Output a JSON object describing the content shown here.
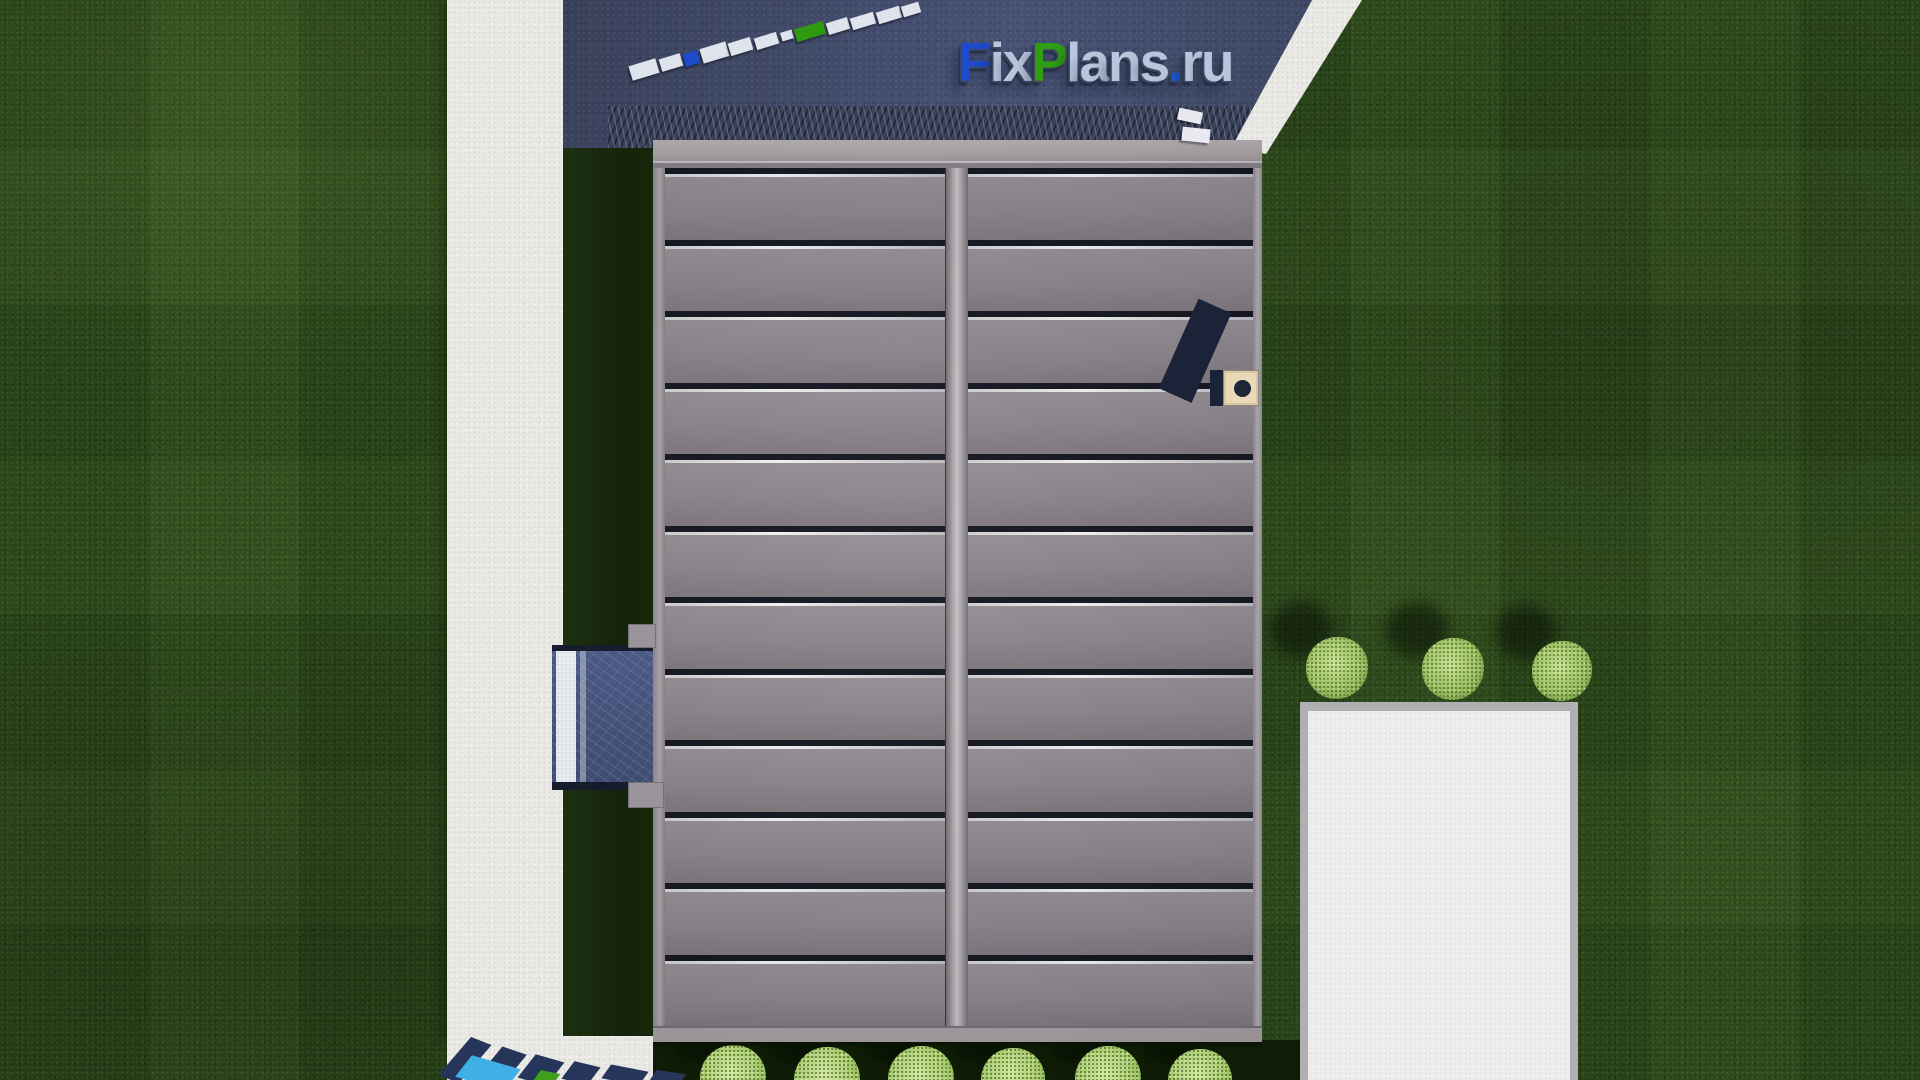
{
  "site": {
    "watermark_text": "FixPlans.ru"
  },
  "logo": {
    "letters": [
      {
        "ch": "F",
        "color": "#1d4bc9"
      },
      {
        "ch": "i",
        "color": "#b9c5dc"
      },
      {
        "ch": "x",
        "color": "#b9c5dc"
      },
      {
        "ch": "P",
        "color": "#2f9e12"
      },
      {
        "ch": "l",
        "color": "#b9c5dc"
      },
      {
        "ch": "a",
        "color": "#b9c5dc"
      },
      {
        "ch": "n",
        "color": "#b9c5dc"
      },
      {
        "ch": "s",
        "color": "#b9c5dc"
      },
      {
        "ch": ".",
        "color": "#1d5ad9"
      },
      {
        "ch": "r",
        "color": "#b9c5dc"
      },
      {
        "ch": "u",
        "color": "#b9c5dc"
      }
    ]
  },
  "colors": {
    "grass": "#2b471b",
    "grass_shadow": "#142309",
    "footpath": "#e9e8e5",
    "driveway": "#3f4860",
    "roof_panel": "#8a838a",
    "roof_seam_dark": "#10131d",
    "roof_seam_light": "#f4f4f6",
    "ridge": "#c6c1c5",
    "chimney_body": "#ead9b6",
    "chimney_flue": "#1e2636",
    "porch": "#46547a",
    "patio": "#ededef",
    "tree": "#97be5d",
    "logo_blue": "#1d4bc9",
    "logo_green": "#2f9e12",
    "logo_silver": "#b9c5dc"
  },
  "roof": {
    "panels_per_slope": 12,
    "slopes": 2
  },
  "ground_watermark": {
    "pieces": [
      {
        "x": 630,
        "y": 62,
        "w": 28,
        "h": 15,
        "rot": -17,
        "color": "#dfe3eb"
      },
      {
        "x": 660,
        "y": 56,
        "w": 22,
        "h": 13,
        "rot": -17,
        "color": "#dfe3eb"
      },
      {
        "x": 684,
        "y": 52,
        "w": 15,
        "h": 13,
        "rot": -17,
        "color": "#1d4bc9"
      },
      {
        "x": 701,
        "y": 45,
        "w": 27,
        "h": 15,
        "rot": -17,
        "color": "#dfe3eb"
      },
      {
        "x": 729,
        "y": 40,
        "w": 23,
        "h": 13,
        "rot": -17,
        "color": "#dfe3eb"
      },
      {
        "x": 755,
        "y": 35,
        "w": 23,
        "h": 12,
        "rot": -17,
        "color": "#dfe3eb"
      },
      {
        "x": 781,
        "y": 31,
        "w": 12,
        "h": 9,
        "rot": -17,
        "color": "#dfe3eb"
      },
      {
        "x": 795,
        "y": 25,
        "w": 30,
        "h": 13,
        "rot": -17,
        "color": "#2f9a10"
      },
      {
        "x": 827,
        "y": 20,
        "w": 22,
        "h": 12,
        "rot": -17,
        "color": "#dfe3eb"
      },
      {
        "x": 851,
        "y": 15,
        "w": 24,
        "h": 12,
        "rot": -17,
        "color": "#dfe3eb"
      },
      {
        "x": 877,
        "y": 9,
        "w": 24,
        "h": 12,
        "rot": -17,
        "color": "#dfe3eb"
      },
      {
        "x": 902,
        "y": 4,
        "w": 18,
        "h": 11,
        "rot": -17,
        "color": "#dfe3eb"
      },
      {
        "x": 1178,
        "y": 110,
        "w": 24,
        "h": 12,
        "rot": 12,
        "color": "#e8eaf0"
      },
      {
        "x": 1182,
        "y": 128,
        "w": 28,
        "h": 14,
        "rot": 6,
        "color": "#e8eaf0"
      }
    ]
  },
  "bottom_watermark": {
    "pieces": [
      {
        "x": 452,
        "y": 1040,
        "w": 26,
        "h": 40,
        "rot": 18,
        "color": "#26365a"
      },
      {
        "x": 487,
        "y": 1050,
        "w": 30,
        "h": 32,
        "rot": 16,
        "color": "#26365a"
      },
      {
        "x": 524,
        "y": 1058,
        "w": 34,
        "h": 24,
        "rot": 14,
        "color": "#26365a"
      },
      {
        "x": 566,
        "y": 1064,
        "w": 30,
        "h": 18,
        "rot": 12,
        "color": "#26365a"
      },
      {
        "x": 604,
        "y": 1068,
        "w": 42,
        "h": 14,
        "rot": 10,
        "color": "#26365a"
      },
      {
        "x": 652,
        "y": 1072,
        "w": 32,
        "h": 10,
        "rot": 8,
        "color": "#26365a"
      },
      {
        "x": 459,
        "y": 1062,
        "w": 58,
        "h": 22,
        "rot": 14,
        "color": "#3fb0e6"
      },
      {
        "x": 536,
        "y": 1072,
        "w": 22,
        "h": 10,
        "rot": 10,
        "color": "#3f9f1a"
      }
    ]
  },
  "trees_right": [
    {
      "cx": 1337,
      "cy": 668,
      "r": 31
    },
    {
      "cx": 1453,
      "cy": 669,
      "r": 31
    },
    {
      "cx": 1562,
      "cy": 671,
      "r": 30
    }
  ],
  "bushes_bottom": [
    {
      "cx": 733,
      "cy": 1078,
      "r": 33
    },
    {
      "cx": 827,
      "cy": 1080,
      "r": 33
    },
    {
      "cx": 921,
      "cy": 1079,
      "r": 33
    },
    {
      "cx": 1013,
      "cy": 1080,
      "r": 32
    },
    {
      "cx": 1108,
      "cy": 1079,
      "r": 33
    },
    {
      "cx": 1200,
      "cy": 1081,
      "r": 32
    }
  ]
}
